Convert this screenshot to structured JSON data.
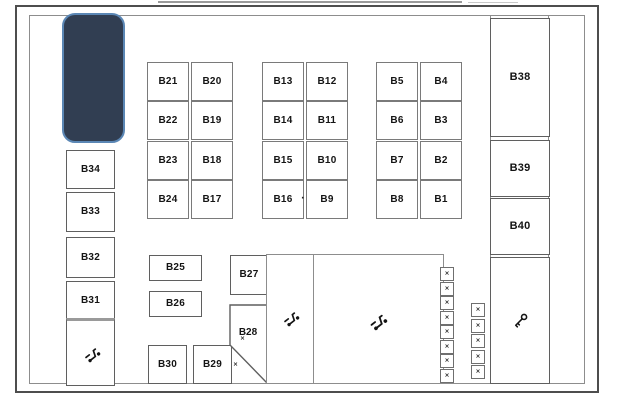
{
  "colors": {
    "highlight_fill": "#313e52",
    "highlight_border": "#5b87b5",
    "outer_border": "#4e4e4e",
    "wall": "#8d8d8d",
    "label": "#141414"
  },
  "left_column": [
    "B34",
    "B33",
    "B32",
    "B31"
  ],
  "right_column": [
    "B38",
    "B39",
    "B40"
  ],
  "blocks": {
    "block1": {
      "rows": [
        [
          "B21",
          "B20"
        ],
        [
          "B22",
          "B19"
        ],
        [
          "B23",
          "B18"
        ],
        [
          "B24",
          "B17"
        ]
      ]
    },
    "block2": {
      "rows": [
        [
          "B13",
          "B12"
        ],
        [
          "B14",
          "B11"
        ],
        [
          "B15",
          "B10"
        ],
        [
          "B16",
          "B9"
        ]
      ]
    },
    "block3": {
      "rows": [
        [
          "B5",
          "B4"
        ],
        [
          "B6",
          "B3"
        ],
        [
          "B7",
          "B2"
        ],
        [
          "B8",
          "B1"
        ]
      ]
    }
  },
  "middle": {
    "b25": "B25",
    "b26": "B26",
    "b27": "B27",
    "b28": "B28",
    "b29": "B29",
    "b30": "B30"
  },
  "markers": {
    "x": "×",
    "dot": "·"
  },
  "icons": {
    "scooter": "scooter-icon",
    "key": "key-icon"
  },
  "small_slots": {
    "column1": [
      "×",
      "×",
      "×",
      "×",
      "×",
      "×",
      "×",
      "×"
    ],
    "column2": [
      "×",
      "×",
      "×",
      "×",
      "×"
    ]
  }
}
